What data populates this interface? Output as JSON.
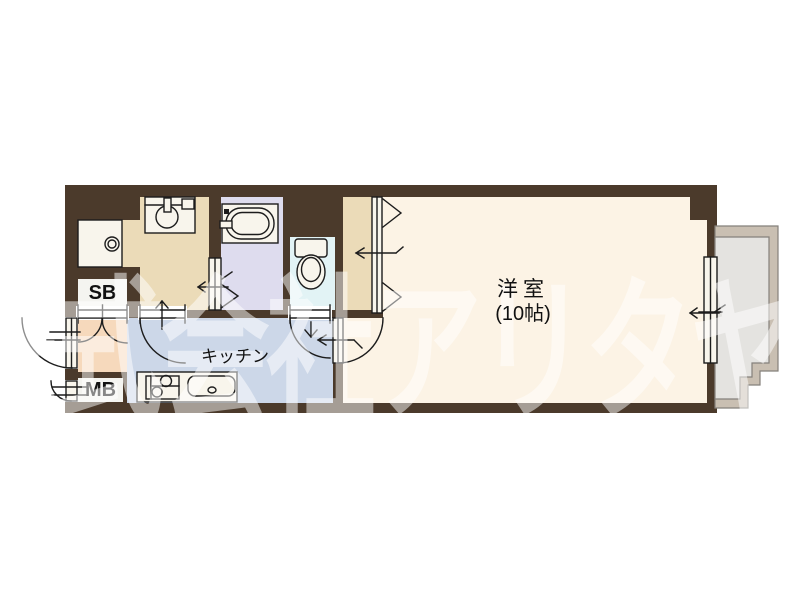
{
  "watermark": "株式会社アリタヤ",
  "labels": {
    "main_room_name": "洋室",
    "main_room_size": "(10帖)",
    "kitchen": "キッチン",
    "shoe_box": "SB",
    "meter_box": "MB"
  },
  "fixtures": [
    "bathtub",
    "toilet",
    "vanity-sink",
    "washing-machine-pan",
    "kitchen-counter",
    "gas-stove",
    "kitchen-sink",
    "balcony",
    "closet-bifold-door",
    "bathroom-folding-door",
    "sliding-window",
    "entrance-door"
  ],
  "colors": {
    "wall": "#4B3A2B",
    "line": "#1C1C1C",
    "main_room_floor": "#FCF3E5",
    "washroom_floor": "#EBDBB8",
    "closet_floor": "#EBDBB8",
    "bathroom_floor": "#DEDCEE",
    "toilet_floor": "#E2F3F5",
    "kitchen_floor": "#CCD7E8",
    "entrance_floor": "#F6D9BC",
    "balcony_band": "#C9BFB2",
    "balcony_floor": "#E4E3E0",
    "fixture_fill": "#F8F5EC",
    "label_box": "#F4F4F0",
    "watermark": "rgba(255,255,255,0.5)"
  }
}
